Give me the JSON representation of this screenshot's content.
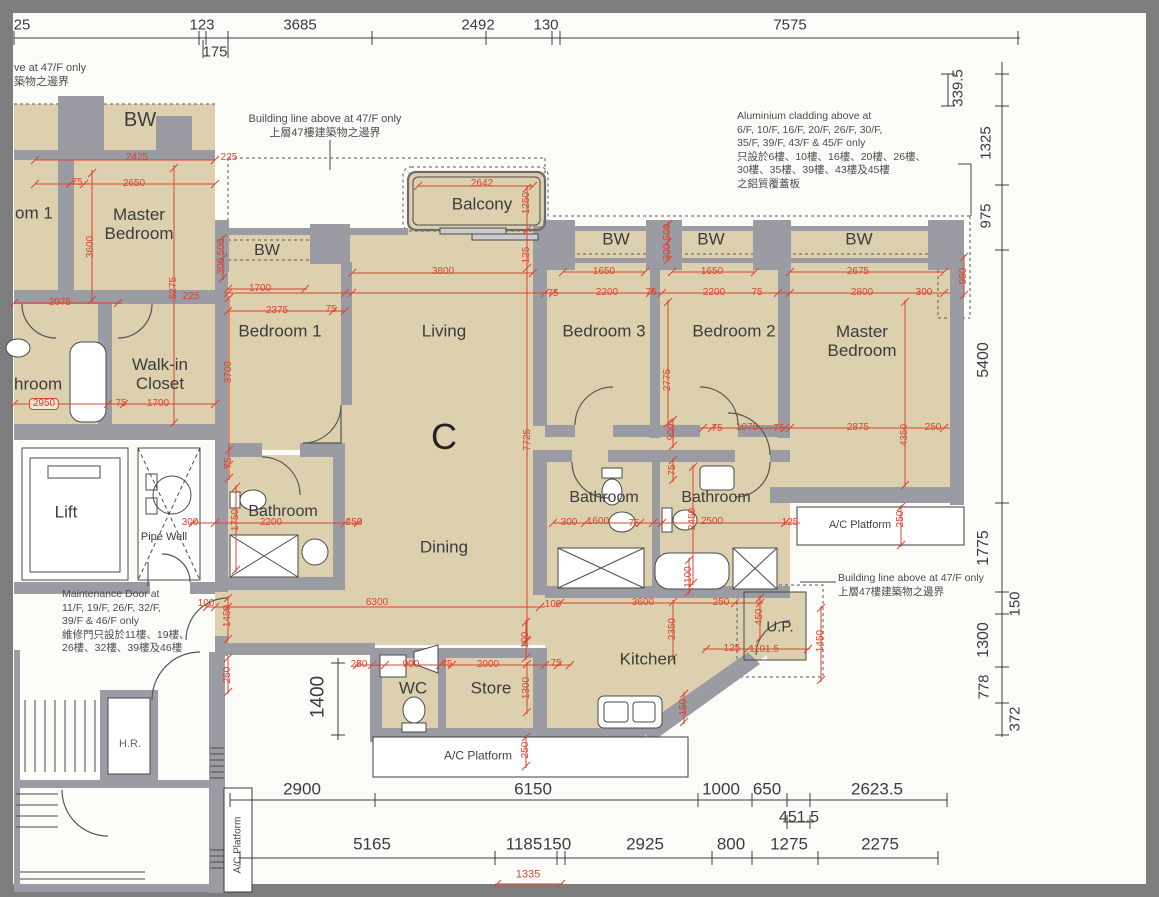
{
  "palette": {
    "floor": "#ddd0ae",
    "wall": "#9b9ba4",
    "dim_red": "#d9452e",
    "ink": "#3c3c3c",
    "mat": "#7d7d7d",
    "paper": "#fbfbf8"
  },
  "unit": {
    "label": "C"
  },
  "rooms": {
    "left_flat": {
      "bw": "BW",
      "bedroom_partial": "om 1",
      "master_bedroom": "Master\nBedroom",
      "bathroom_partial": "hroom",
      "walk_in_closet": "Walk-in\nCloset",
      "lift": "Lift",
      "pipe_well": "Pipe Well",
      "hr": "H.R."
    },
    "unit_c": {
      "balcony": "Balcony",
      "bw_living": "BW",
      "bw_bed3": "BW",
      "bw_bed2": "BW",
      "bw_master": "BW",
      "bedroom_1": "Bedroom 1",
      "living": "Living",
      "dining": "Dining",
      "bedroom_3": "Bedroom 3",
      "bedroom_2": "Bedroom 2",
      "master_bedroom": "Master\nBedroom",
      "bathroom_1": "Bathroom",
      "bathroom_2": "Bathroom",
      "bathroom_3": "Bathroom",
      "kitchen": "Kitchen",
      "up": "U.P.",
      "wc": "WC",
      "store": "Store",
      "ac_platform_right": "A/C Platform",
      "ac_platform_bottom": "A/C Platform",
      "ac_platform_left": "A/C Platform"
    }
  },
  "annotations": {
    "top_left_partial": "ve at 47/F only\n築物之邊界",
    "building_line_top": "Building line above at 47/F only\n上層47樓建築物之邊界",
    "aluminium_cladding": "Aluminium cladding above at\n6/F, 10/F, 16/F, 20/F, 26/F, 30/F,\n35/F, 39/F, 43/F & 45/F only\n只設於6樓、10樓、16樓、20樓、26樓、\n30樓、35樓、39樓、43樓及45樓\n之鋁質覆蓋板",
    "building_line_right": "Building line above at 47/F only\n上層47樓建築物之邊界",
    "maintenance_door": "Maintenance Door at\n11/F, 19/F, 26/F, 32/F,\n39/F & 46/F only\n維修門只設於11樓、19樓、\n26樓、32樓、39樓及46樓"
  },
  "dimensions": {
    "black": [
      {
        "t": "25",
        "x": 22,
        "y": 25,
        "s": 15
      },
      {
        "t": "123",
        "x": 202,
        "y": 25,
        "s": 15
      },
      {
        "t": "3685",
        "x": 300,
        "y": 25,
        "s": 15
      },
      {
        "t": "2492",
        "x": 478,
        "y": 25,
        "s": 15
      },
      {
        "t": "130",
        "x": 546,
        "y": 25,
        "s": 15
      },
      {
        "t": "7575",
        "x": 790,
        "y": 25,
        "s": 15
      },
      {
        "t": "175",
        "x": 215,
        "y": 52,
        "s": 15
      },
      {
        "t": "339.5",
        "x": 958,
        "y": 88,
        "r": 1,
        "s": 15
      },
      {
        "t": "1325",
        "x": 986,
        "y": 143,
        "r": 1,
        "s": 15
      },
      {
        "t": "975",
        "x": 986,
        "y": 216,
        "r": 1,
        "s": 15
      },
      {
        "t": "5400",
        "x": 984,
        "y": 360,
        "r": 1,
        "s": 16
      },
      {
        "t": "1775",
        "x": 984,
        "y": 548,
        "r": 1,
        "s": 16
      },
      {
        "t": "150",
        "x": 1015,
        "y": 604,
        "r": 1,
        "s": 15
      },
      {
        "t": "1300",
        "x": 984,
        "y": 640,
        "r": 1,
        "s": 16
      },
      {
        "t": "778",
        "x": 984,
        "y": 687,
        "r": 1,
        "s": 15
      },
      {
        "t": "372",
        "x": 1015,
        "y": 719,
        "r": 1,
        "s": 15
      },
      {
        "t": "2900",
        "x": 302,
        "y": 789,
        "s": 17
      },
      {
        "t": "6150",
        "x": 533,
        "y": 789,
        "s": 17
      },
      {
        "t": "1000",
        "x": 721,
        "y": 789,
        "s": 17
      },
      {
        "t": "650",
        "x": 767,
        "y": 789,
        "s": 17
      },
      {
        "t": "2623.5",
        "x": 877,
        "y": 789,
        "s": 17
      },
      {
        "t": "451.5",
        "x": 799,
        "y": 818,
        "s": 16
      },
      {
        "t": "5165",
        "x": 372,
        "y": 844,
        "s": 17
      },
      {
        "t": "1185",
        "x": 524,
        "y": 844,
        "s": 17
      },
      {
        "t": "150",
        "x": 557,
        "y": 844,
        "s": 17
      },
      {
        "t": "2925",
        "x": 645,
        "y": 844,
        "s": 17
      },
      {
        "t": "800",
        "x": 731,
        "y": 844,
        "s": 17
      },
      {
        "t": "1275",
        "x": 789,
        "y": 844,
        "s": 17
      },
      {
        "t": "2275",
        "x": 880,
        "y": 844,
        "s": 17
      },
      {
        "t": "1400",
        "x": 318,
        "y": 697,
        "r": 1,
        "s": 19
      }
    ],
    "red": [
      {
        "t": "2425",
        "x": 137,
        "y": 158
      },
      {
        "t": "2650",
        "x": 134,
        "y": 184
      },
      {
        "t": "75",
        "x": 77,
        "y": 183
      },
      {
        "t": "225",
        "x": 229,
        "y": 158
      },
      {
        "t": "500",
        "x": 222,
        "y": 247,
        "r": 1
      },
      {
        "t": "300",
        "x": 222,
        "y": 266,
        "r": 1
      },
      {
        "t": "3600",
        "x": 91,
        "y": 247,
        "r": 1
      },
      {
        "t": "5275",
        "x": 174,
        "y": 288,
        "r": 1
      },
      {
        "t": "225",
        "x": 191,
        "y": 297
      },
      {
        "t": "2075",
        "x": 60,
        "y": 303
      },
      {
        "t": "2950",
        "x": 44,
        "y": 404,
        "b": 1
      },
      {
        "t": "75",
        "x": 121,
        "y": 404
      },
      {
        "t": "1700",
        "x": 158,
        "y": 404
      },
      {
        "t": "300",
        "x": 190,
        "y": 523
      },
      {
        "t": "1750",
        "x": 236,
        "y": 520,
        "r": 1
      },
      {
        "t": "75",
        "x": 229,
        "y": 463,
        "r": 1
      },
      {
        "t": "3700",
        "x": 229,
        "y": 372,
        "r": 1
      },
      {
        "t": "1700",
        "x": 260,
        "y": 289
      },
      {
        "t": "2375",
        "x": 277,
        "y": 311
      },
      {
        "t": "75",
        "x": 331,
        "y": 310
      },
      {
        "t": "2642",
        "x": 482,
        "y": 184
      },
      {
        "t": "1250",
        "x": 527,
        "y": 203,
        "r": 1
      },
      {
        "t": "125",
        "x": 527,
        "y": 255,
        "r": 1
      },
      {
        "t": "3800",
        "x": 443,
        "y": 272
      },
      {
        "t": "7725",
        "x": 528,
        "y": 440,
        "r": 1
      },
      {
        "t": "75",
        "x": 553,
        "y": 294
      },
      {
        "t": "1650",
        "x": 604,
        "y": 272
      },
      {
        "t": "2200",
        "x": 607,
        "y": 293
      },
      {
        "t": "75",
        "x": 651,
        "y": 293
      },
      {
        "t": "500",
        "x": 668,
        "y": 232,
        "r": 1
      },
      {
        "t": "300",
        "x": 668,
        "y": 252,
        "r": 1
      },
      {
        "t": "1650",
        "x": 712,
        "y": 272
      },
      {
        "t": "2200",
        "x": 714,
        "y": 293
      },
      {
        "t": "75",
        "x": 757,
        "y": 293
      },
      {
        "t": "2675",
        "x": 858,
        "y": 272
      },
      {
        "t": "2800",
        "x": 862,
        "y": 293
      },
      {
        "t": "300",
        "x": 924,
        "y": 293
      },
      {
        "t": "950",
        "x": 964,
        "y": 276,
        "r": 1
      },
      {
        "t": "2775",
        "x": 668,
        "y": 380,
        "r": 1
      },
      {
        "t": "4350",
        "x": 905,
        "y": 435,
        "r": 1
      },
      {
        "t": "900",
        "x": 672,
        "y": 432,
        "r": 1
      },
      {
        "t": "1075",
        "x": 747,
        "y": 428
      },
      {
        "t": "75",
        "x": 717,
        "y": 429
      },
      {
        "t": "75",
        "x": 779,
        "y": 429
      },
      {
        "t": "2875",
        "x": 858,
        "y": 428
      },
      {
        "t": "250",
        "x": 933,
        "y": 428
      },
      {
        "t": "75",
        "x": 673,
        "y": 470,
        "r": 1
      },
      {
        "t": "300",
        "x": 569,
        "y": 523
      },
      {
        "t": "1600",
        "x": 598,
        "y": 522
      },
      {
        "t": "75",
        "x": 634,
        "y": 524
      },
      {
        "t": "2450",
        "x": 693,
        "y": 519,
        "r": 1
      },
      {
        "t": "2500",
        "x": 712,
        "y": 522
      },
      {
        "t": "125",
        "x": 790,
        "y": 523
      },
      {
        "t": "250",
        "x": 901,
        "y": 519,
        "r": 1
      },
      {
        "t": "1100",
        "x": 689,
        "y": 577,
        "r": 1
      },
      {
        "t": "2200",
        "x": 271,
        "y": 523
      },
      {
        "t": "250",
        "x": 354,
        "y": 523
      },
      {
        "t": "100",
        "x": 206,
        "y": 604
      },
      {
        "t": "6300",
        "x": 377,
        "y": 603
      },
      {
        "t": "1450",
        "x": 228,
        "y": 616,
        "r": 1
      },
      {
        "t": "250",
        "x": 228,
        "y": 675,
        "r": 1
      },
      {
        "t": "100",
        "x": 526,
        "y": 640,
        "r": 1
      },
      {
        "t": "100",
        "x": 553,
        "y": 605
      },
      {
        "t": "250",
        "x": 359,
        "y": 665
      },
      {
        "t": "900",
        "x": 411,
        "y": 665
      },
      {
        "t": "75",
        "x": 447,
        "y": 665
      },
      {
        "t": "2000",
        "x": 488,
        "y": 665
      },
      {
        "t": "75",
        "x": 556,
        "y": 664
      },
      {
        "t": "1300",
        "x": 527,
        "y": 688,
        "r": 1
      },
      {
        "t": "3600",
        "x": 643,
        "y": 603
      },
      {
        "t": "250",
        "x": 721,
        "y": 603
      },
      {
        "t": "2350",
        "x": 673,
        "y": 629,
        "r": 1
      },
      {
        "t": "450",
        "x": 760,
        "y": 617,
        "r": 1
      },
      {
        "t": "125",
        "x": 732,
        "y": 649
      },
      {
        "t": "1101.5",
        "x": 764,
        "y": 650
      },
      {
        "t": "1450",
        "x": 821,
        "y": 641,
        "r": 1
      },
      {
        "t": "150",
        "x": 684,
        "y": 707,
        "r": 1
      },
      {
        "t": "250",
        "x": 526,
        "y": 750,
        "r": 1
      },
      {
        "t": "1335",
        "x": 528,
        "y": 875,
        "s": 11
      }
    ]
  }
}
